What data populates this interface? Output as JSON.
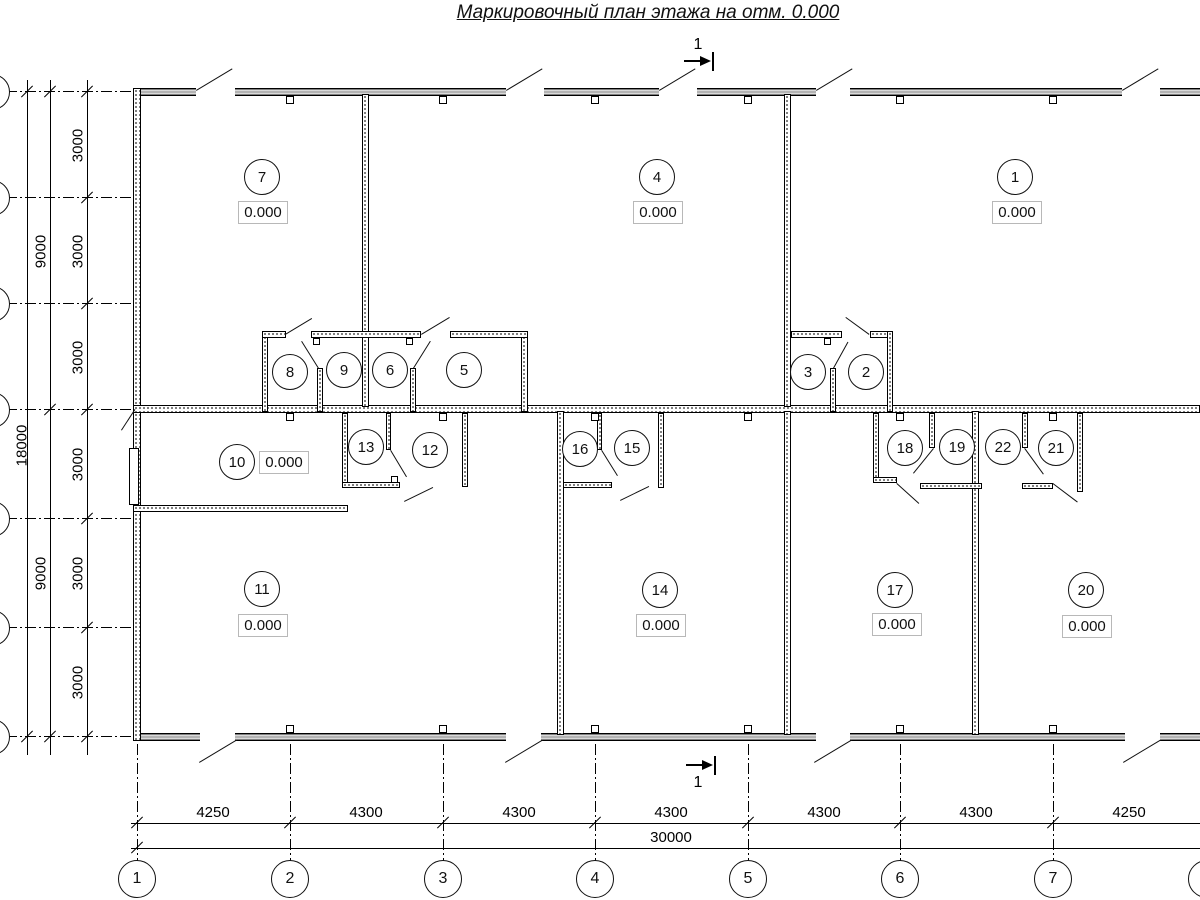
{
  "title": "Маркировочный план этажа на отм. 0.000",
  "section": {
    "label": "1"
  },
  "colors": {
    "line": "#000000",
    "band_fill": "#b3b3b3",
    "elev_box_border": "#b8b8b8"
  },
  "rooms": [
    {
      "num": "1",
      "elev": "0.000"
    },
    {
      "num": "2"
    },
    {
      "num": "3"
    },
    {
      "num": "4",
      "elev": "0.000"
    },
    {
      "num": "5"
    },
    {
      "num": "6"
    },
    {
      "num": "7",
      "elev": "0.000"
    },
    {
      "num": "8"
    },
    {
      "num": "9"
    },
    {
      "num": "10",
      "elev": "0.000"
    },
    {
      "num": "11",
      "elev": "0.000"
    },
    {
      "num": "12"
    },
    {
      "num": "13"
    },
    {
      "num": "14",
      "elev": "0.000"
    },
    {
      "num": "15"
    },
    {
      "num": "16"
    },
    {
      "num": "17",
      "elev": "0.000"
    },
    {
      "num": "18"
    },
    {
      "num": "19"
    },
    {
      "num": "20",
      "elev": "0.000"
    },
    {
      "num": "21"
    },
    {
      "num": "22"
    }
  ],
  "axes_bottom": [
    "1",
    "2",
    "3",
    "4",
    "5",
    "6",
    "7"
  ],
  "dims_bottom": {
    "segments": [
      "4250",
      "4300",
      "4300",
      "4300",
      "4300",
      "4300",
      "4250"
    ],
    "total": "30000"
  },
  "dims_left": {
    "segments": [
      "3000",
      "3000",
      "3000",
      "3000",
      "3000",
      "3000"
    ],
    "halves": [
      "9000",
      "9000"
    ],
    "total": "18000"
  }
}
